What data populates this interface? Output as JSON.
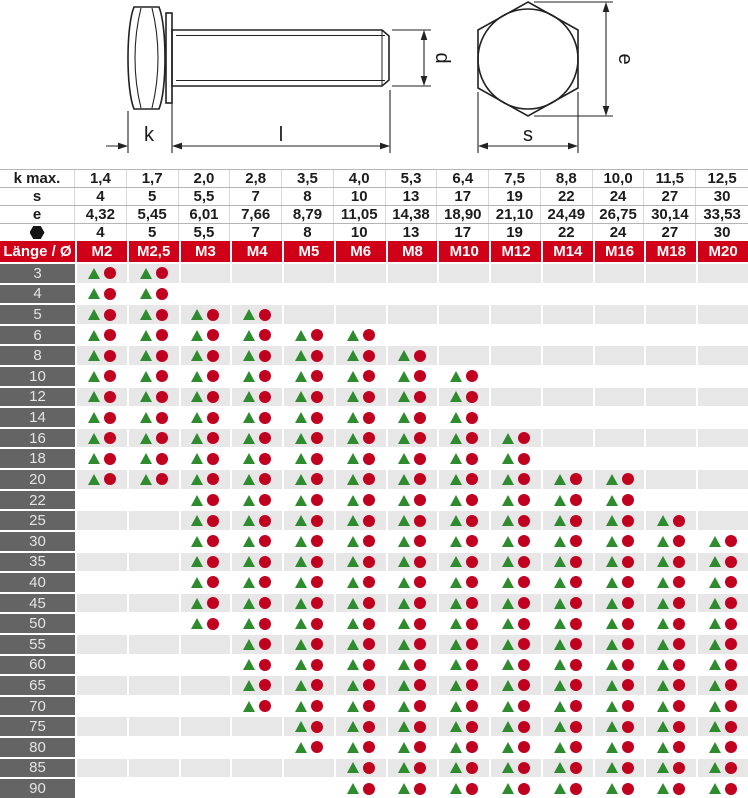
{
  "drawing": {
    "side_view_labels": {
      "k": "k",
      "l": "l",
      "d": "d"
    },
    "top_view_labels": {
      "e": "e",
      "s": "s"
    }
  },
  "table": {
    "spec_rows": [
      {
        "label": "k max.",
        "icon": false,
        "values": [
          "1,4",
          "1,7",
          "2,0",
          "2,8",
          "3,5",
          "4,0",
          "5,3",
          "6,4",
          "7,5",
          "8,8",
          "10,0",
          "11,5",
          "12,5"
        ]
      },
      {
        "label": "s",
        "icon": false,
        "values": [
          "4",
          "5",
          "5,5",
          "7",
          "8",
          "10",
          "13",
          "17",
          "19",
          "22",
          "24",
          "27",
          "30"
        ]
      },
      {
        "label": "e",
        "icon": false,
        "values": [
          "4,32",
          "5,45",
          "6,01",
          "7,66",
          "8,79",
          "11,05",
          "14,38",
          "18,90",
          "21,10",
          "24,49",
          "26,75",
          "30,14",
          "33,53"
        ]
      },
      {
        "label": "hexagon-icon",
        "icon": true,
        "values": [
          "4",
          "5",
          "5,5",
          "7",
          "8",
          "10",
          "13",
          "17",
          "19",
          "22",
          "24",
          "27",
          "30"
        ]
      }
    ],
    "header_row": {
      "corner": "Länge / Ø",
      "columns": [
        "M2",
        "M2,5",
        "M3",
        "M4",
        "M5",
        "M6",
        "M8",
        "M10",
        "M12",
        "M14",
        "M16",
        "M18",
        "M20"
      ]
    },
    "rows": [
      {
        "length": "3",
        "available": [
          1,
          1,
          0,
          0,
          0,
          0,
          0,
          0,
          0,
          0,
          0,
          0,
          0
        ]
      },
      {
        "length": "4",
        "available": [
          1,
          1,
          0,
          0,
          0,
          0,
          0,
          0,
          0,
          0,
          0,
          0,
          0
        ]
      },
      {
        "length": "5",
        "available": [
          1,
          1,
          1,
          1,
          0,
          0,
          0,
          0,
          0,
          0,
          0,
          0,
          0
        ]
      },
      {
        "length": "6",
        "available": [
          1,
          1,
          1,
          1,
          1,
          1,
          0,
          0,
          0,
          0,
          0,
          0,
          0
        ]
      },
      {
        "length": "8",
        "available": [
          1,
          1,
          1,
          1,
          1,
          1,
          1,
          0,
          0,
          0,
          0,
          0,
          0
        ]
      },
      {
        "length": "10",
        "available": [
          1,
          1,
          1,
          1,
          1,
          1,
          1,
          1,
          0,
          0,
          0,
          0,
          0
        ]
      },
      {
        "length": "12",
        "available": [
          1,
          1,
          1,
          1,
          1,
          1,
          1,
          1,
          0,
          0,
          0,
          0,
          0
        ]
      },
      {
        "length": "14",
        "available": [
          1,
          1,
          1,
          1,
          1,
          1,
          1,
          1,
          0,
          0,
          0,
          0,
          0
        ]
      },
      {
        "length": "16",
        "available": [
          1,
          1,
          1,
          1,
          1,
          1,
          1,
          1,
          1,
          0,
          0,
          0,
          0
        ]
      },
      {
        "length": "18",
        "available": [
          1,
          1,
          1,
          1,
          1,
          1,
          1,
          1,
          1,
          0,
          0,
          0,
          0
        ]
      },
      {
        "length": "20",
        "available": [
          1,
          1,
          1,
          1,
          1,
          1,
          1,
          1,
          1,
          1,
          1,
          0,
          0
        ]
      },
      {
        "length": "22",
        "available": [
          0,
          0,
          1,
          1,
          1,
          1,
          1,
          1,
          1,
          1,
          1,
          0,
          0
        ]
      },
      {
        "length": "25",
        "available": [
          0,
          0,
          1,
          1,
          1,
          1,
          1,
          1,
          1,
          1,
          1,
          1,
          0
        ]
      },
      {
        "length": "30",
        "available": [
          0,
          0,
          1,
          1,
          1,
          1,
          1,
          1,
          1,
          1,
          1,
          1,
          1
        ]
      },
      {
        "length": "35",
        "available": [
          0,
          0,
          1,
          1,
          1,
          1,
          1,
          1,
          1,
          1,
          1,
          1,
          1
        ]
      },
      {
        "length": "40",
        "available": [
          0,
          0,
          1,
          1,
          1,
          1,
          1,
          1,
          1,
          1,
          1,
          1,
          1
        ]
      },
      {
        "length": "45",
        "available": [
          0,
          0,
          1,
          1,
          1,
          1,
          1,
          1,
          1,
          1,
          1,
          1,
          1
        ]
      },
      {
        "length": "50",
        "available": [
          0,
          0,
          1,
          1,
          1,
          1,
          1,
          1,
          1,
          1,
          1,
          1,
          1
        ]
      },
      {
        "length": "55",
        "available": [
          0,
          0,
          0,
          1,
          1,
          1,
          1,
          1,
          1,
          1,
          1,
          1,
          1
        ]
      },
      {
        "length": "60",
        "available": [
          0,
          0,
          0,
          1,
          1,
          1,
          1,
          1,
          1,
          1,
          1,
          1,
          1
        ]
      },
      {
        "length": "65",
        "available": [
          0,
          0,
          0,
          1,
          1,
          1,
          1,
          1,
          1,
          1,
          1,
          1,
          1
        ]
      },
      {
        "length": "70",
        "available": [
          0,
          0,
          0,
          1,
          1,
          1,
          1,
          1,
          1,
          1,
          1,
          1,
          1
        ]
      },
      {
        "length": "75",
        "available": [
          0,
          0,
          0,
          0,
          1,
          1,
          1,
          1,
          1,
          1,
          1,
          1,
          1
        ]
      },
      {
        "length": "80",
        "available": [
          0,
          0,
          0,
          0,
          1,
          1,
          1,
          1,
          1,
          1,
          1,
          1,
          1
        ]
      },
      {
        "length": "85",
        "available": [
          0,
          0,
          0,
          0,
          0,
          1,
          1,
          1,
          1,
          1,
          1,
          1,
          1
        ]
      },
      {
        "length": "90",
        "available": [
          0,
          0,
          0,
          0,
          0,
          1,
          1,
          1,
          1,
          1,
          1,
          1,
          1
        ]
      }
    ],
    "marker_legend": {
      "triangle": "green-triangle-marker",
      "circle": "red-circle-marker"
    }
  },
  "colors": {
    "header_red": "#d00018",
    "marker_green": "#2e8b2e",
    "marker_red": "#c10020",
    "row_header_bg": "#646464",
    "row_header_text": "#e3e3e3",
    "row_alt_bg": "#e7e7e7"
  }
}
